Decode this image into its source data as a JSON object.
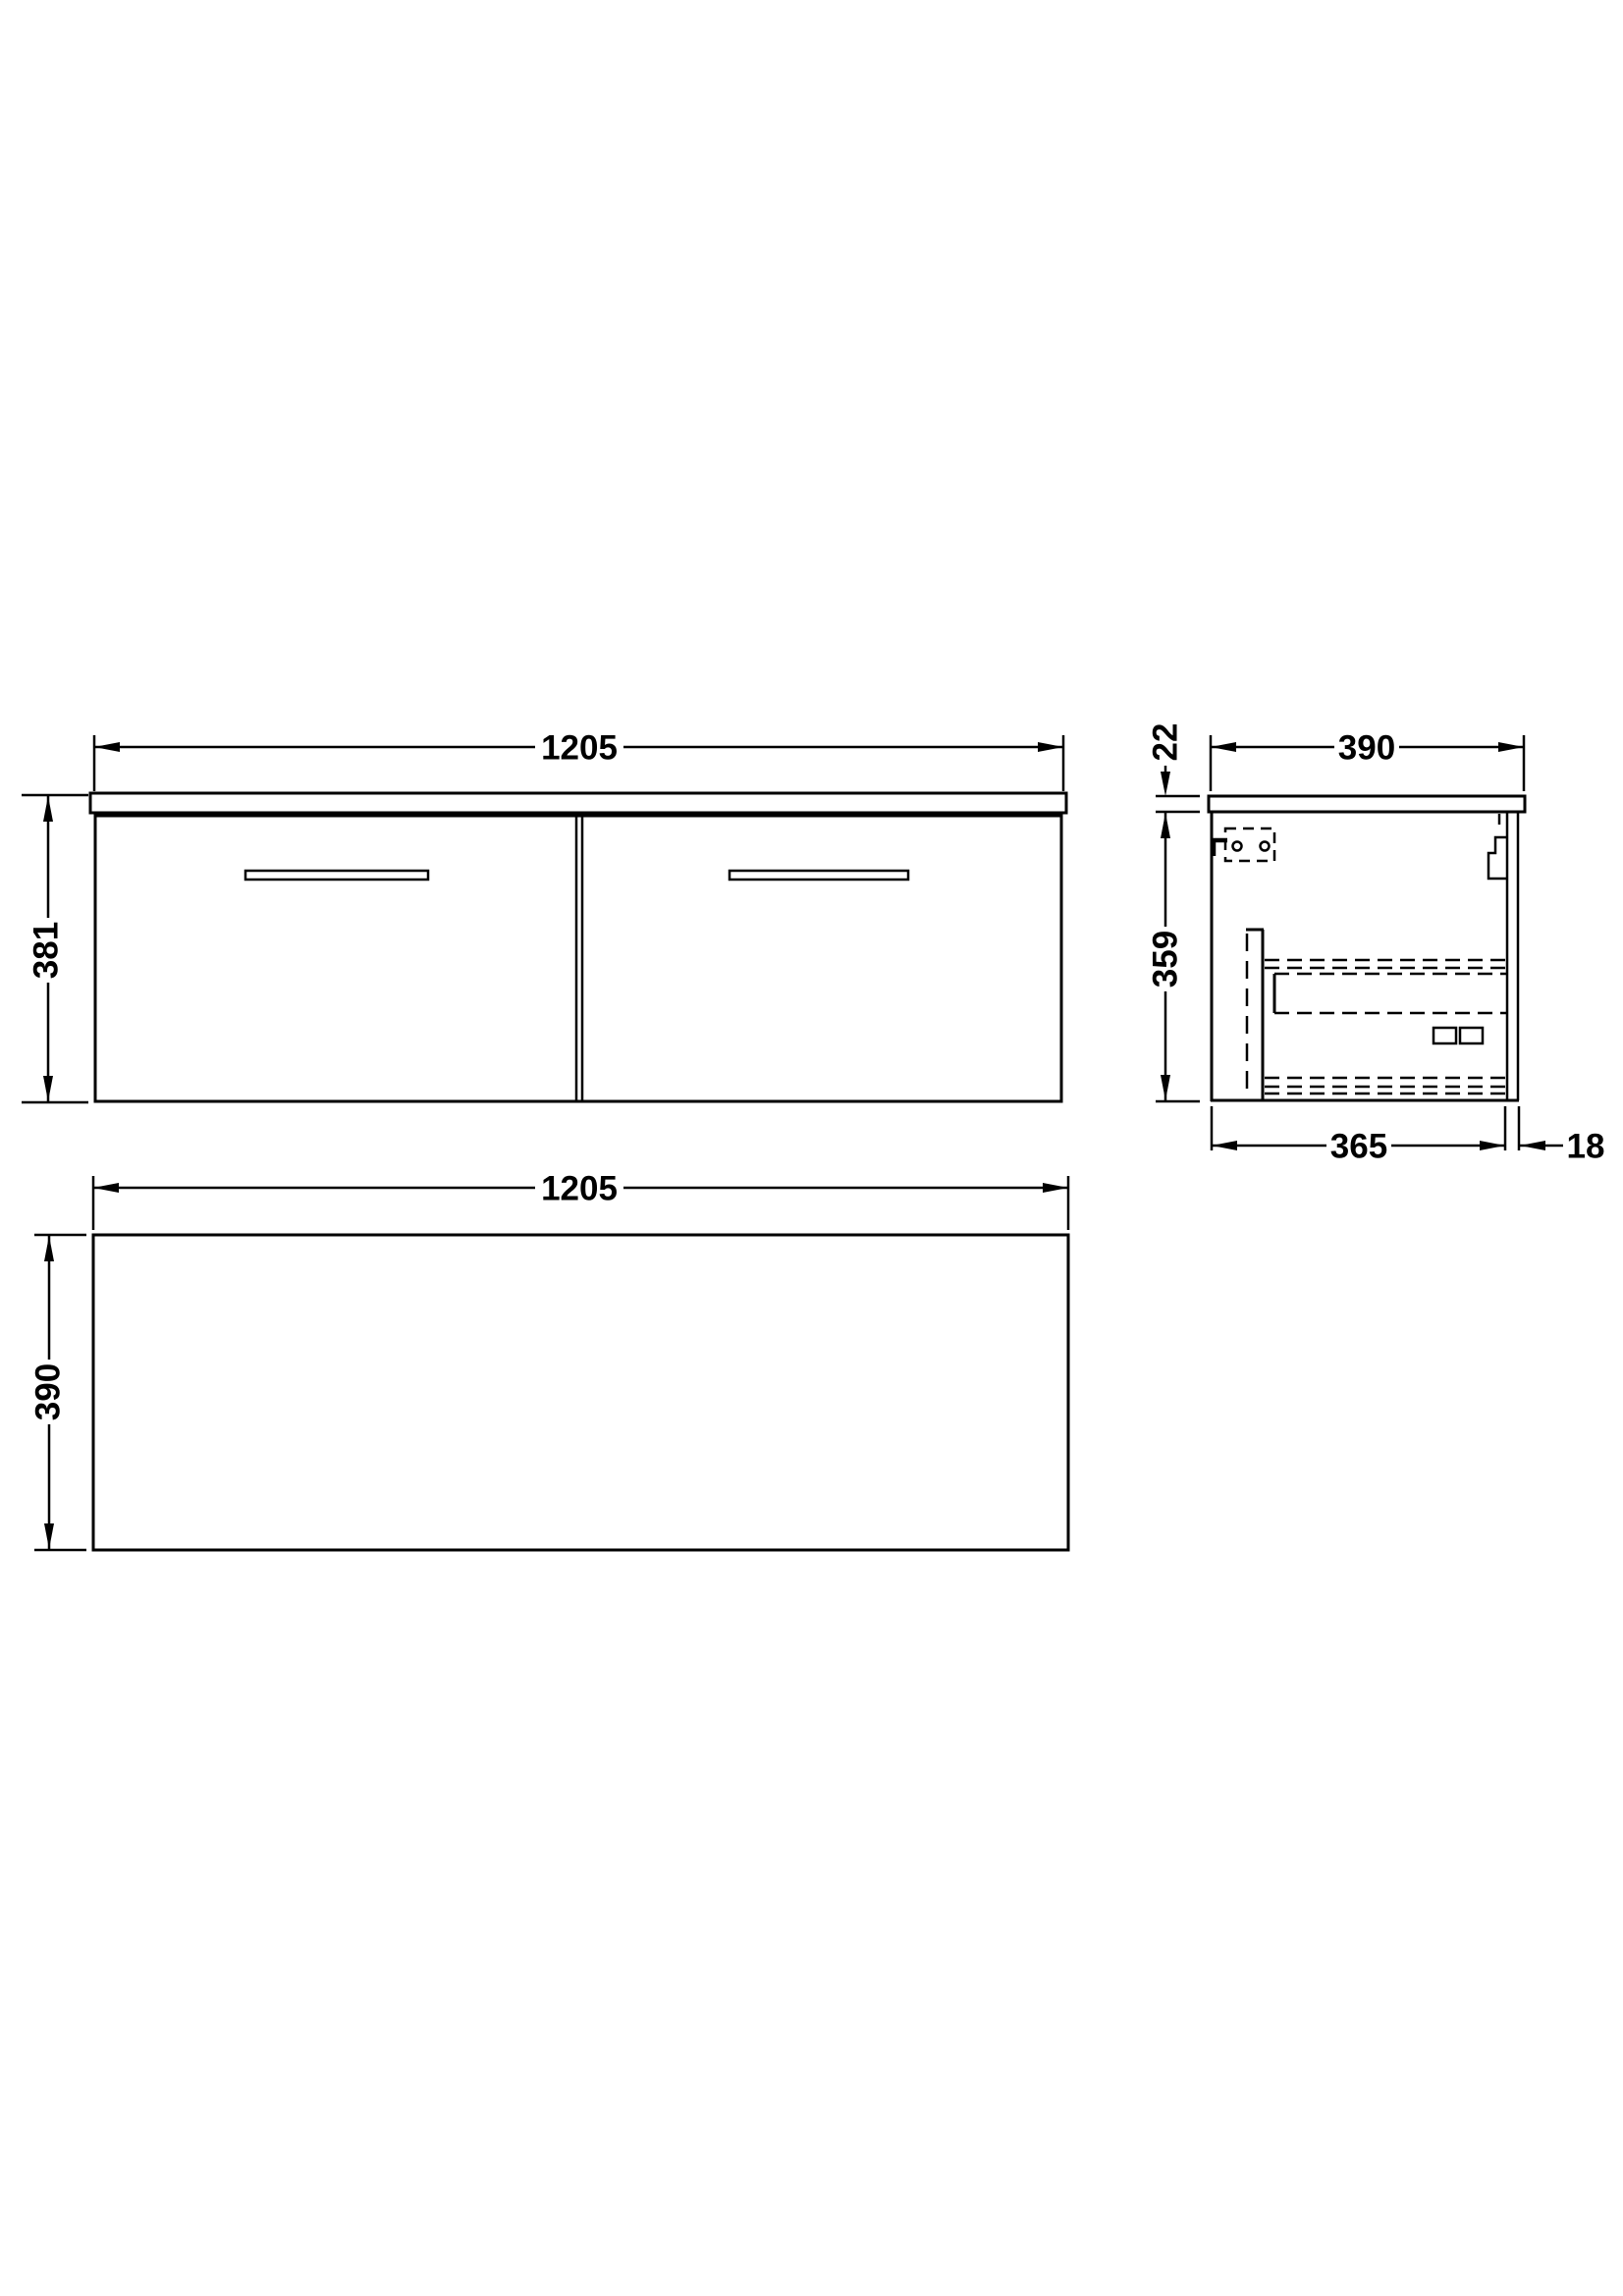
{
  "drawing": {
    "background_color": "#ffffff",
    "line_color": "#000000",
    "views": {
      "front": {
        "width": "1205",
        "height": "381"
      },
      "side": {
        "depth": "390",
        "worktop_thickness": "22",
        "cabinet_height": "359",
        "cabinet_depth": "365",
        "back_panel": "18"
      },
      "plan": {
        "width": "1205",
        "depth": "390"
      }
    }
  }
}
